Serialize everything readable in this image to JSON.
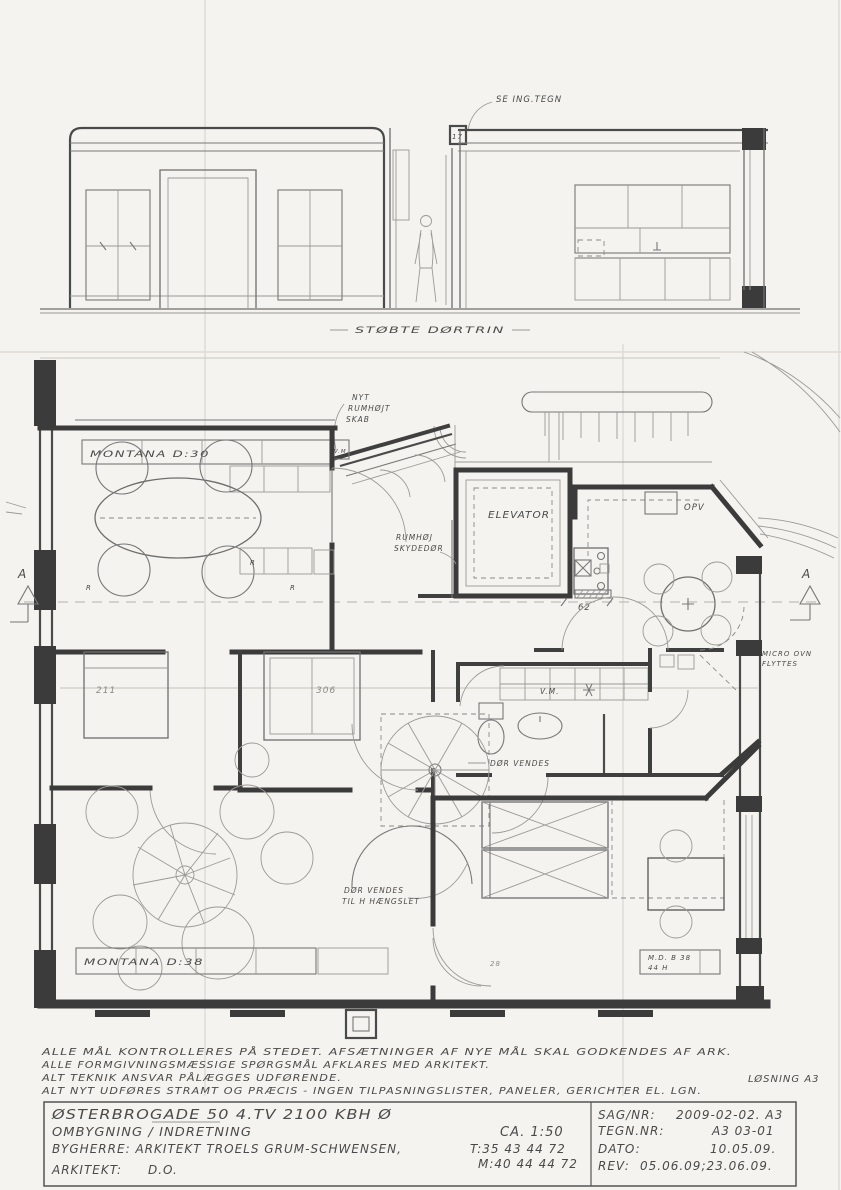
{
  "colors": {
    "paper": "#f4f3ef",
    "pencil": "#777777",
    "wall": "#3b3b3b",
    "handwriting": "#4a4a4a"
  },
  "section": {
    "callout": "SE ING.TEGN",
    "door_dim": "17",
    "caption": "STØBTE DØRTRIN"
  },
  "plan": {
    "section_marker": "A",
    "labels": {
      "nyt_line1": "NYT",
      "nyt_line2": "RUMHØJT",
      "nyt_line3": "SKAB",
      "montana_top": "MONTANA  D:30",
      "elevator": "ELEVATOR",
      "skydedor_line1": "RUMHØJ",
      "skydedor_line2": "SKYDEDØR",
      "opv": "OPV",
      "vm": "V.M.",
      "dor_vendes": "DØR VENDES",
      "dor_vendes2_line1": "DØR VENDES",
      "dor_vendes2_line2": "TIL H HÆNGSLET",
      "montana_bottom": "MONTANA  D:38",
      "md_line1": "M.D. B 38",
      "md_line2": "44 H",
      "micro_line1": "MICRO OVN",
      "micro_line2": "FLYTTES",
      "radiator": "R"
    },
    "dimensions": {
      "d62": "62",
      "d306": "306",
      "d211": "211",
      "d28": "28"
    }
  },
  "notes": {
    "line1": "ALLE MÅL KONTROLLERES PÅ STEDET.  AFSÆTNINGER AF NYE MÅL SKAL GODKENDES AF ARK.",
    "line2": "ALLE FORMGIVNINGSMÆSSIGE SPØRGSMÅL AFKLARES MED ARKITEKT.",
    "line3": "ALT TEKNIK ANSVAR PÅLÆGGES UDFØRENDE.",
    "line4": "ALT NYT UDFØRES STRAMT OG PRÆCIS - INGEN TILPASNINGSLISTER, PANELER, GERICHTER EL. LGN.",
    "solution": "LØSNING A3"
  },
  "title_block": {
    "address": "ØSTERBROGADE  50 4.TV  2100  KBH  Ø",
    "project": "OMBYGNING / INDRETNING",
    "scale": "CA. 1:50",
    "client": "BYGHERRE:  ARKITEKT  TROELS  GRUM-SCHWENSEN,",
    "phone": "T:35 43 44 72",
    "mobile": "M:40 44 44 72",
    "architect_label": "ARKITEKT:",
    "architect": "D.O.",
    "case_label": "SAG/NR:",
    "case_no": "2009-02-02. A3",
    "drawing_label": "TEGN.NR:",
    "drawing_no": "A3  03-01",
    "date_label": "DATO:",
    "date": "10.05.09.",
    "rev_label": "REV:",
    "rev": "05.06.09;23.06.09."
  }
}
